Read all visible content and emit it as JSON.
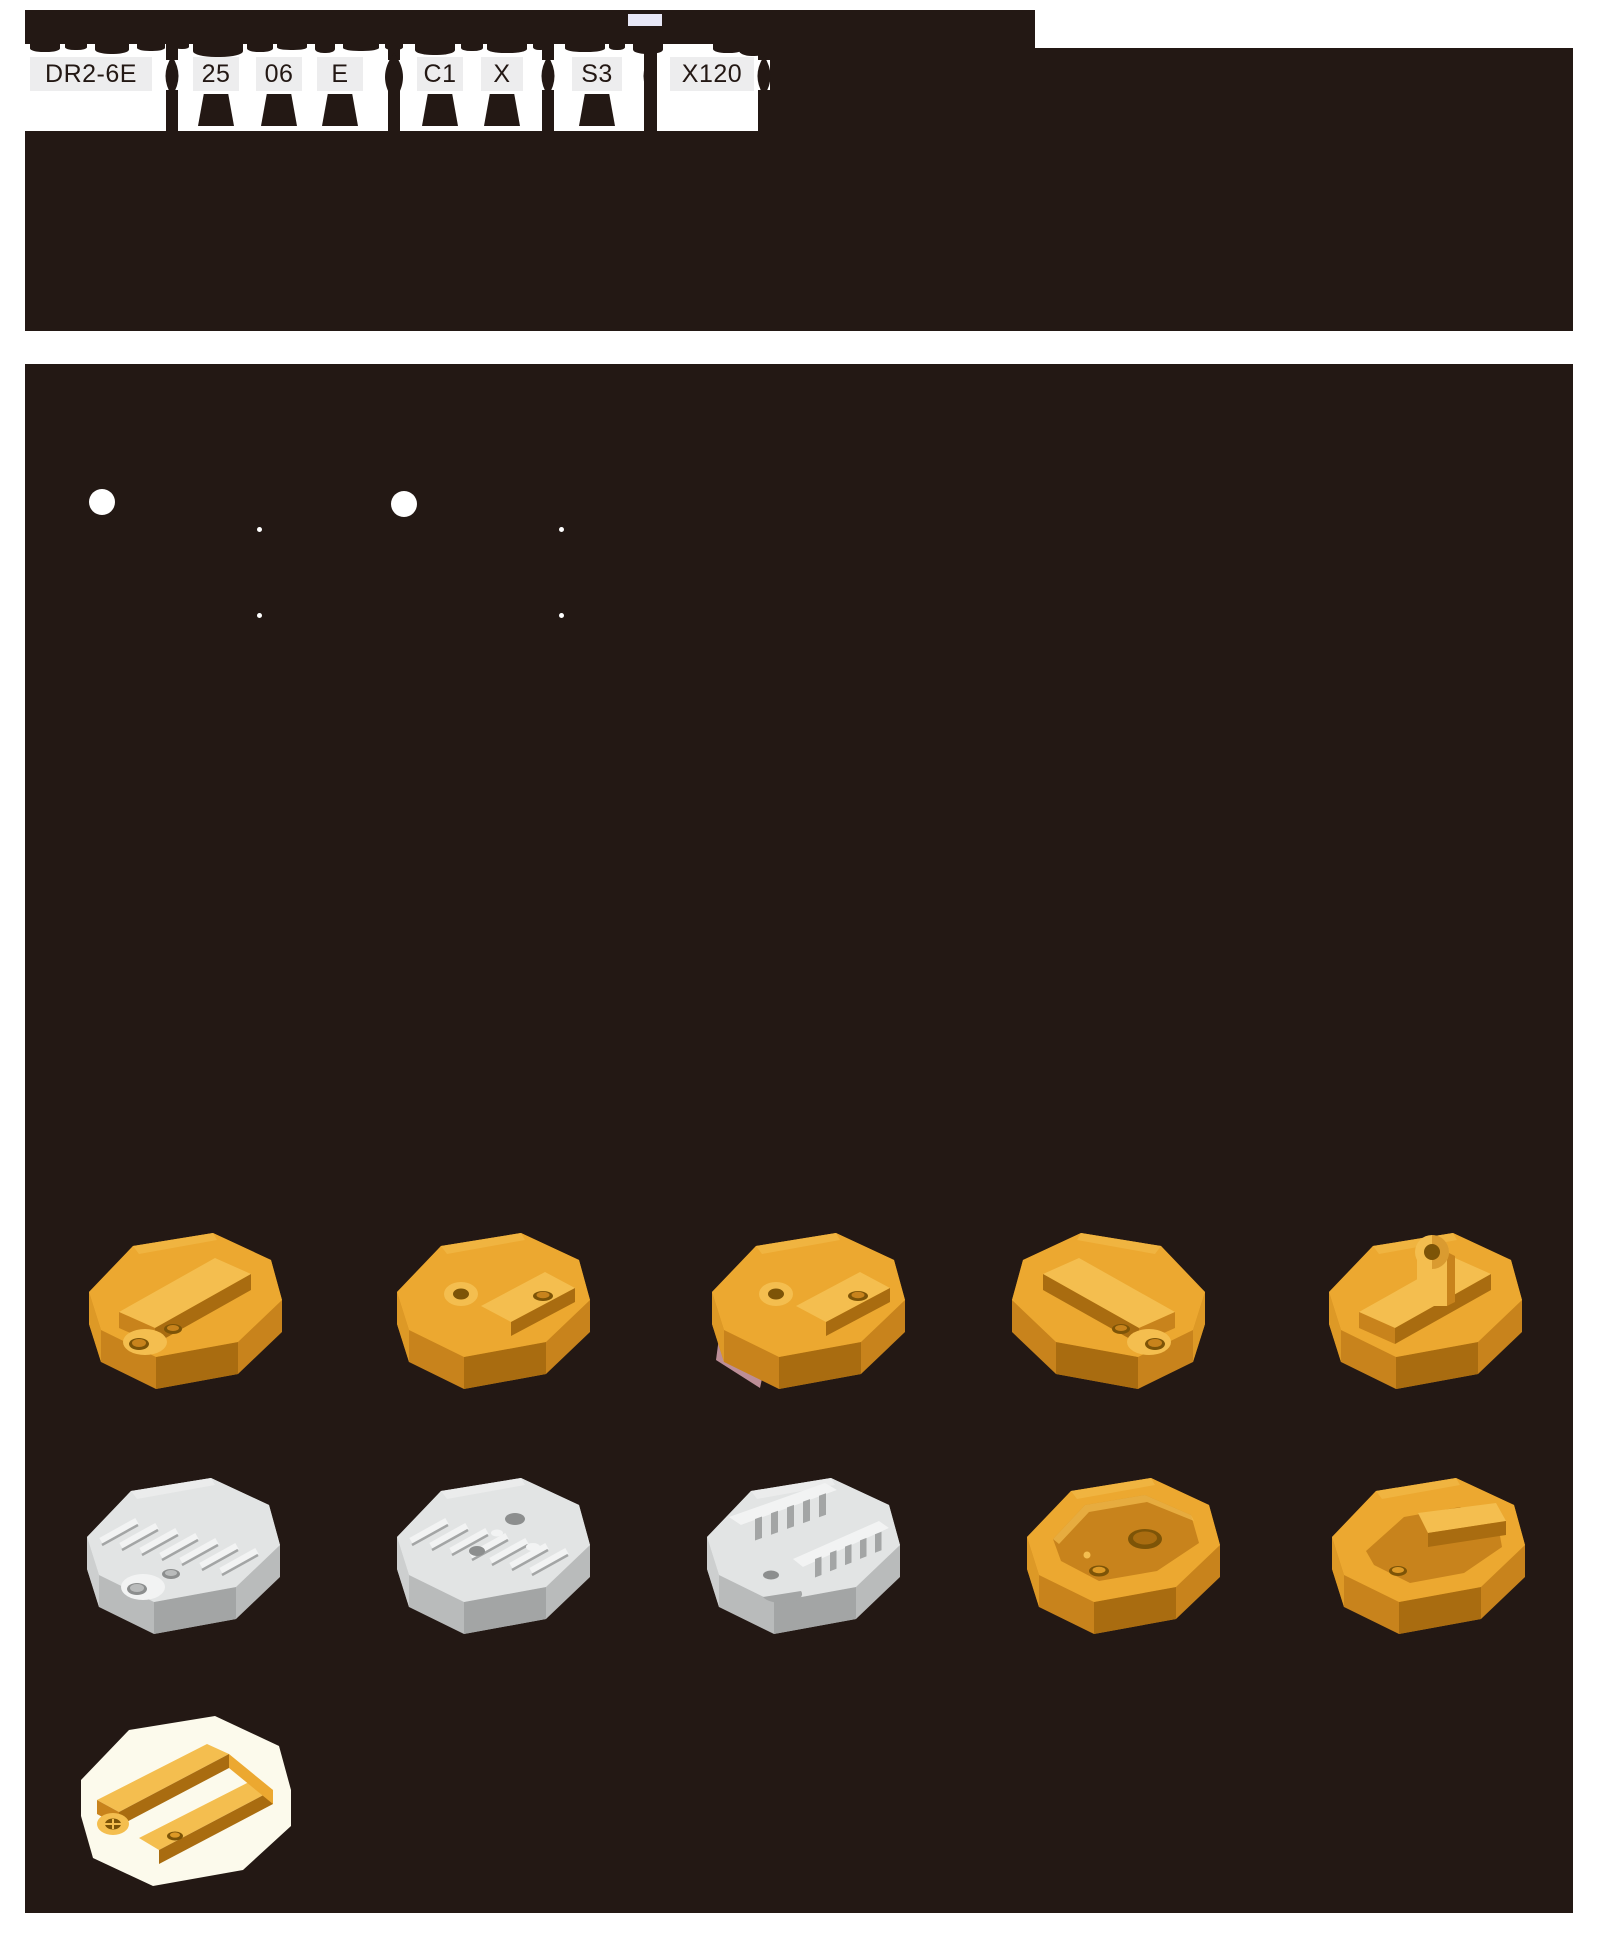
{
  "ordering_code": {
    "segments": [
      "DR2-6E",
      "25",
      "06",
      "E",
      "C1",
      "X",
      "S3",
      "X120"
    ]
  },
  "colors": {
    "page_bg": "#ffffff",
    "panel_dark": "#231814",
    "code_box_bg": "#ededee",
    "code_box_text": "#231814",
    "lavender_chip": "#e7e7f6",
    "pink_shadow": "#bc8e97",
    "cream_backdrop": "#fcfaec",
    "gold": {
      "side": "#c8831c",
      "side2": "#dd9926",
      "top": "#eca830",
      "top2": "#f4be4f",
      "dark": "#a96c10",
      "deep": "#7d5407"
    },
    "gray": {
      "side": "#b9bbbb",
      "side2": "#cdcfcf",
      "top": "#e2e4e4",
      "top2": "#f2f3f3",
      "dark": "#a3a5a5",
      "deep": "#8c8e8e"
    }
  },
  "parts": [
    {
      "name": "gold-socket-channel-left",
      "palette": "gold",
      "layers": [
        "base",
        "channel",
        "ear2"
      ],
      "x": 32,
      "y": 846,
      "mirror": false
    },
    {
      "name": "gold-socket-eyelet-side",
      "palette": "gold",
      "layers": [
        "base",
        "eyelet"
      ],
      "x": 340,
      "y": 846,
      "mirror": false
    },
    {
      "name": "gold-socket-eyelet-shadow",
      "palette": "gold",
      "layers": [
        "pink",
        "base",
        "eyelet"
      ],
      "x": 655,
      "y": 846,
      "mirror": false
    },
    {
      "name": "gold-socket-channel-right",
      "palette": "gold",
      "layers": [
        "base",
        "channel",
        "ear2"
      ],
      "x": 962,
      "y": 846,
      "mirror": true
    },
    {
      "name": "gold-socket-eyelet-up",
      "palette": "gold",
      "layers": [
        "base",
        "channel",
        "tab"
      ],
      "x": 1272,
      "y": 846,
      "mirror": false
    },
    {
      "name": "gray-socket-finned-body",
      "palette": "gray",
      "layers": [
        "base",
        "fins",
        "ear2"
      ],
      "x": 30,
      "y": 1091,
      "mirror": false
    },
    {
      "name": "gray-socket-finned-plate",
      "palette": "gray",
      "layers": [
        "base",
        "fins",
        "holes"
      ],
      "x": 340,
      "y": 1091,
      "mirror": false
    },
    {
      "name": "gray-socket-slotted-rails",
      "palette": "gray",
      "layers": [
        "base",
        "rails"
      ],
      "x": 650,
      "y": 1091,
      "mirror": false
    },
    {
      "name": "gold-tray-large-hole",
      "palette": "gold",
      "layers": [
        "base",
        "tray"
      ],
      "x": 970,
      "y": 1091,
      "mirror": false
    },
    {
      "name": "gold-tray-ledge",
      "palette": "gold",
      "layers": [
        "base",
        "tray2"
      ],
      "x": 1275,
      "y": 1091,
      "mirror": false
    },
    {
      "name": "gold-frame-on-backdrop",
      "palette": "gold",
      "layers": [
        "backdrop",
        "frame"
      ],
      "x": 32,
      "y": 1336,
      "mirror": false
    }
  ],
  "decor": {
    "bumps": [
      [
        5,
        30,
        8
      ],
      [
        40,
        22,
        6
      ],
      [
        70,
        34,
        10
      ],
      [
        112,
        28,
        7
      ],
      [
        150,
        14,
        5
      ],
      [
        168,
        50,
        13
      ],
      [
        222,
        26,
        8
      ],
      [
        252,
        30,
        6
      ],
      [
        290,
        20,
        9
      ],
      [
        318,
        36,
        7
      ],
      [
        360,
        18,
        6
      ],
      [
        390,
        40,
        11
      ],
      [
        436,
        22,
        7
      ],
      [
        462,
        40,
        9
      ],
      [
        508,
        14,
        6
      ],
      [
        540,
        40,
        8
      ],
      [
        584,
        16,
        6
      ],
      [
        608,
        30,
        10
      ],
      [
        688,
        30,
        9
      ],
      [
        714,
        28,
        12
      ]
    ],
    "lenses": [
      [
        147,
        0
      ],
      [
        369,
        1
      ],
      [
        523,
        0
      ],
      [
        625,
        0
      ],
      [
        739,
        0
      ]
    ],
    "feet_centers": [
      191,
      254,
      315,
      415,
      477,
      572
    ],
    "bullets_large": [
      [
        64,
        125
      ],
      [
        366,
        127
      ]
    ],
    "bullets_small": [
      [
        232,
        163
      ],
      [
        534,
        163
      ],
      [
        232,
        249
      ],
      [
        534,
        249
      ]
    ]
  }
}
